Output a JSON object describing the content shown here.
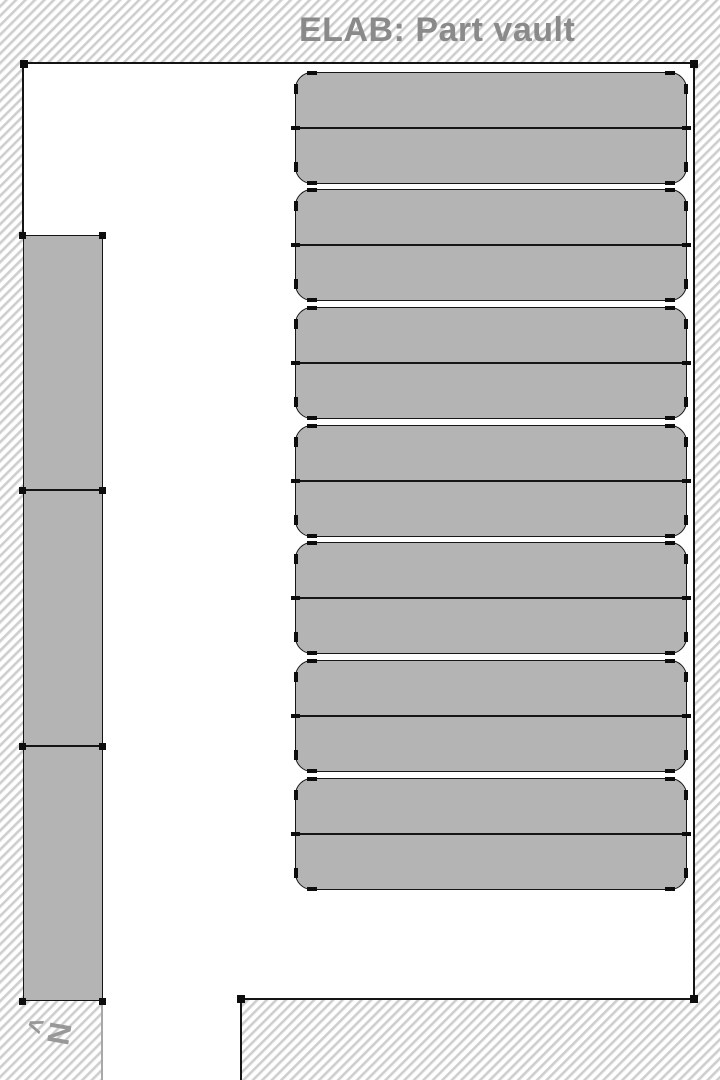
{
  "title": "ELAB: Part vault",
  "compass": {
    "arrow": "<",
    "label": "N"
  },
  "colors": {
    "floor": "#ffffff",
    "furniture": "#b4b4b4",
    "outline": "#141414",
    "title_text": "#8a8a8a",
    "compass": "#989898"
  },
  "map": {
    "right_shelf_units": {
      "count": 7,
      "rows_per_unit": 2,
      "x": 295,
      "width": 392,
      "height": 112,
      "tops": [
        72,
        189,
        307,
        425,
        542,
        660,
        778
      ]
    },
    "left_rack_column": {
      "count": 3,
      "x": 22.5,
      "width": 80,
      "top": 235,
      "bottom": 1001,
      "divider_ys": [
        490,
        746
      ]
    },
    "wall_corner_markers": [
      [
        23.5,
        63.5
      ],
      [
        693.5,
        63.5
      ],
      [
        693.5,
        998.5
      ],
      [
        240.5,
        998.5
      ]
    ],
    "rack_marker_xs": [
      22.5,
      102.5
    ],
    "rack_marker_ys": [
      235,
      490,
      746,
      1001
    ]
  }
}
